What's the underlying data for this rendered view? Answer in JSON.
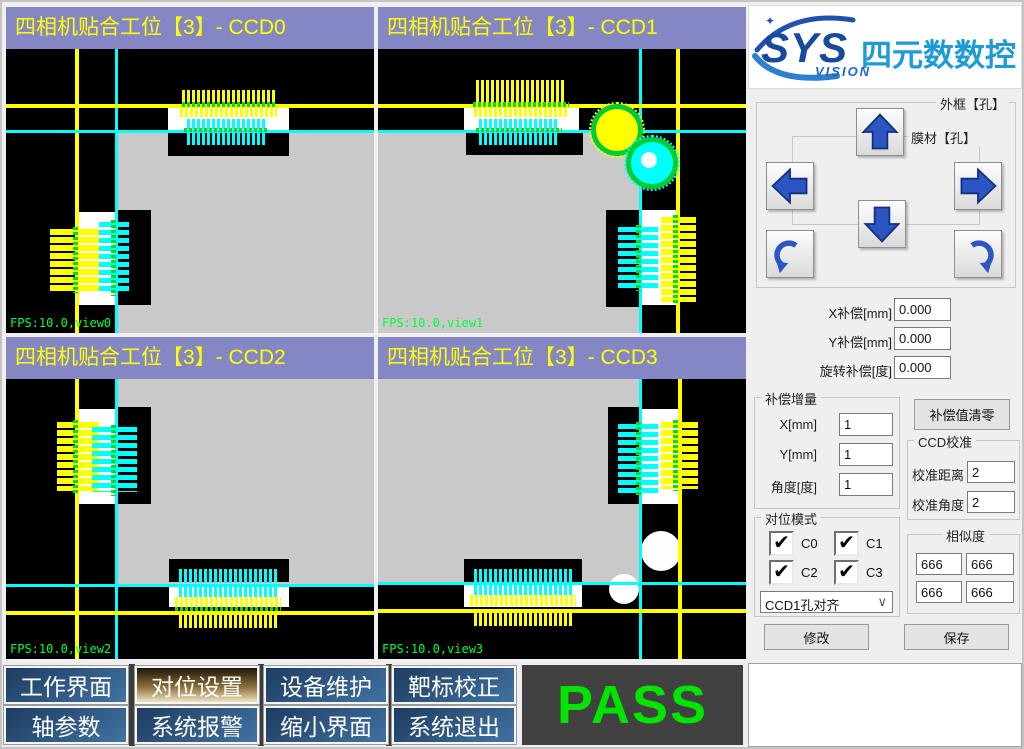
{
  "cameras": [
    {
      "title": "四相机贴合工位【3】- CCD0",
      "fps": "FPS:10.0,view0"
    },
    {
      "title": "四相机贴合工位【3】- CCD1",
      "fps": "FPS:10.0,view1"
    },
    {
      "title": "四相机贴合工位【3】- CCD2",
      "fps": "FPS:10.0,view2"
    },
    {
      "title": "四相机贴合工位【3】- CCD3",
      "fps": "FPS:10.0,view3"
    }
  ],
  "logo": {
    "sys": "SYS",
    "vision": "VISION",
    "brand": "四元数数控",
    "sparkle": "✦"
  },
  "jog": {
    "outer_label": "外框【孔】",
    "inner_label": "膜材【孔】"
  },
  "offsets": {
    "x_label": "X补偿[mm]",
    "x_value": "0.000",
    "y_label": "Y补偿[mm]",
    "y_value": "0.000",
    "r_label": "旋转补偿[度]",
    "r_value": "0.000"
  },
  "increment": {
    "title": "补偿增量",
    "x_label": "X[mm]",
    "x_value": "1",
    "y_label": "Y[mm]",
    "y_value": "1",
    "a_label": "角度[度]",
    "a_value": "1"
  },
  "clear_button": "补偿值清零",
  "calibration": {
    "title": "CCD校准",
    "dist_label": "校准距离",
    "dist_value": "2",
    "ang_label": "校准角度",
    "ang_value": "2"
  },
  "align_mode": {
    "title": "对位模式",
    "checkboxes": [
      {
        "label": "C0",
        "checked": true
      },
      {
        "label": "C1",
        "checked": true
      },
      {
        "label": "C2",
        "checked": true
      },
      {
        "label": "C3",
        "checked": true
      }
    ],
    "dropdown_value": "CCD1孔对齐"
  },
  "similarity": {
    "title": "相似度",
    "values": [
      "666",
      "666",
      "666",
      "666"
    ]
  },
  "actions": {
    "modify": "修改",
    "save": "保存"
  },
  "nav": {
    "buttons": [
      {
        "label": "工作界面",
        "active": false
      },
      {
        "label": "对位设置",
        "active": true
      },
      {
        "label": "设备维护",
        "active": false
      },
      {
        "label": "靶标校正",
        "active": false
      },
      {
        "label": "轴参数",
        "active": false
      },
      {
        "label": "系统报警",
        "active": false
      },
      {
        "label": "缩小界面",
        "active": false
      },
      {
        "label": "系统退出",
        "active": false
      }
    ]
  },
  "status": {
    "result": "PASS"
  },
  "icons": {
    "check": "✔",
    "chevron": "∨"
  },
  "colors": {
    "header_purple": "#8487C4",
    "title_yellow": "#FFFF00",
    "crosshair_yellow": "#FFFF00",
    "crosshair_cyan": "#00FFFF",
    "marker_green": "#00DD22",
    "fps_green": "#00FF33",
    "camera_gray": "#C9C9C9",
    "pass_green": "#00E400",
    "nav_blue": "#2B5580",
    "nav_active_brown": "#8A6D3B",
    "logo_navy": "#174A9C",
    "brand_blue": "#1E9AD6",
    "arrow_blue": "#2B56C4"
  }
}
